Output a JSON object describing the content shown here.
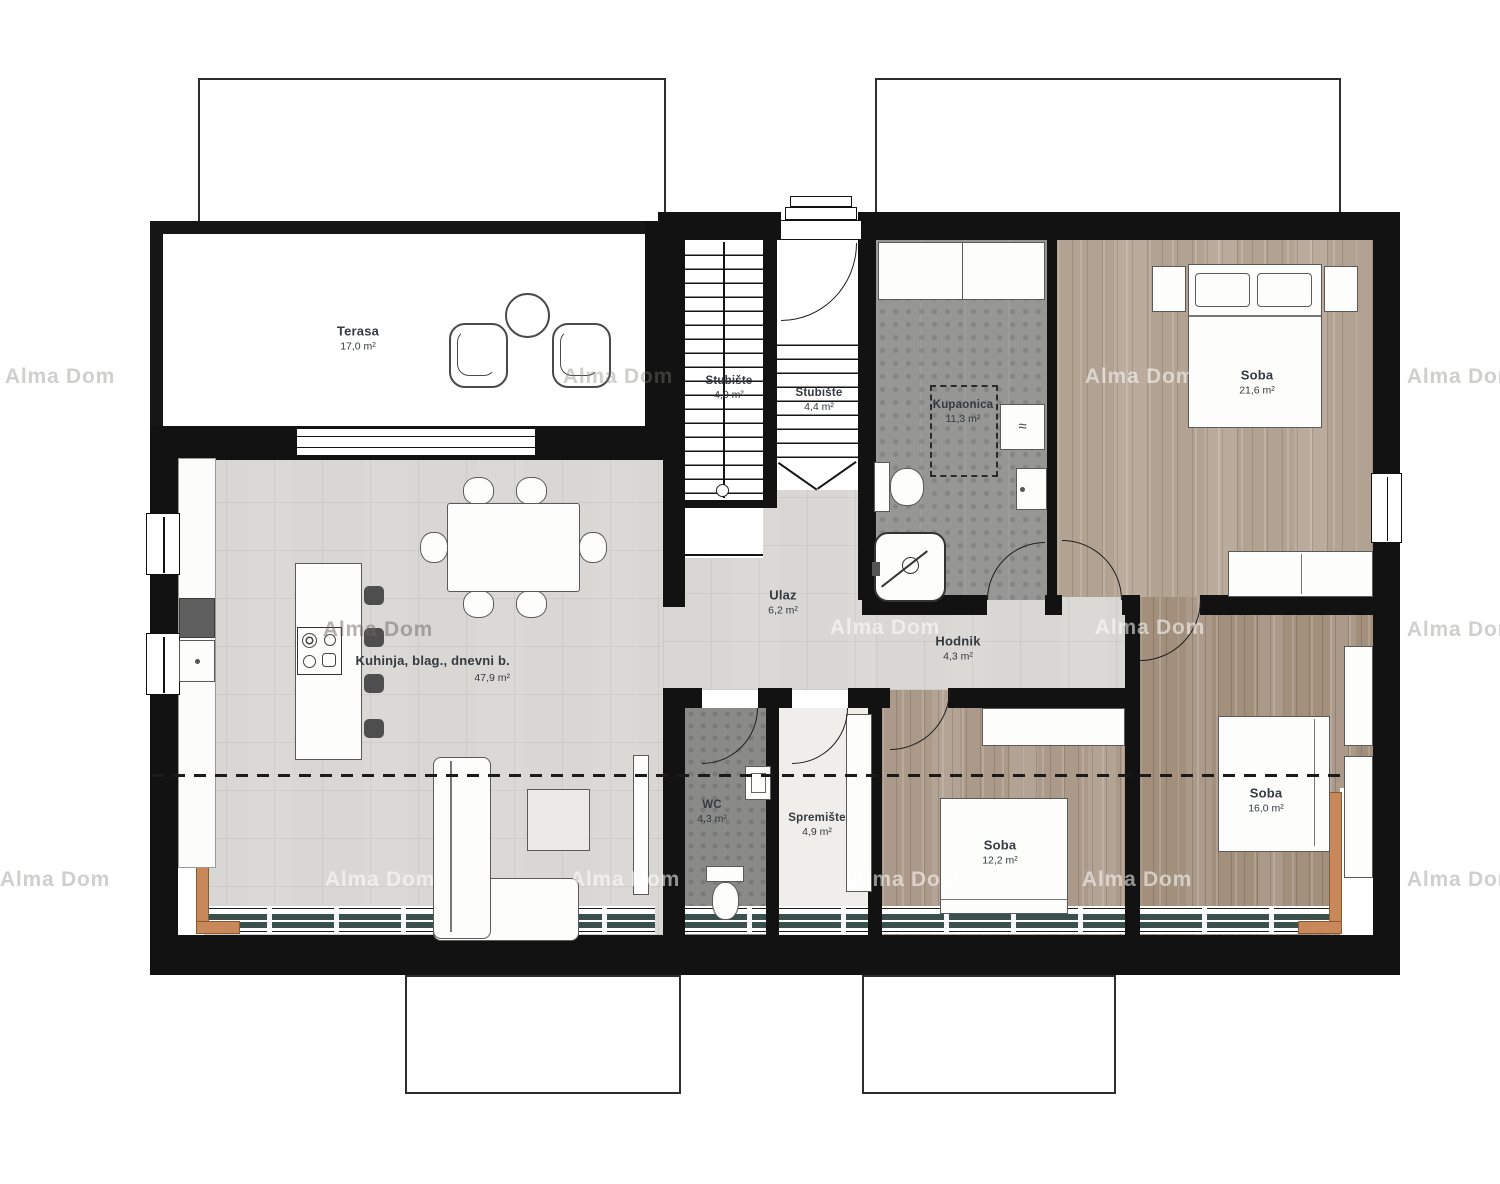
{
  "plan": {
    "watermark": "Alma Dom",
    "rooms": {
      "terasa": {
        "name": "Terasa",
        "area": "17,0 m²"
      },
      "stubiste1": {
        "name": "Stubište",
        "area": "4,0 m²"
      },
      "stubiste2": {
        "name": "Stubište",
        "area": "4,4 m²"
      },
      "kupaonica": {
        "name": "Kupaonica",
        "area": "11,3 m²"
      },
      "soba1": {
        "name": "Soba",
        "area": "21,6 m²"
      },
      "kuhinja": {
        "name": "Kuhinja, blag., dnevni b.",
        "area": "47,9 m²"
      },
      "ulaz": {
        "name": "Ulaz",
        "area": "6,2 m²"
      },
      "hodnik": {
        "name": "Hodnik",
        "area": "4,3 m²"
      },
      "wc": {
        "name": "WC",
        "area": "4,3 m²"
      },
      "spremiste": {
        "name": "Spremište",
        "area": "4,9 m²"
      },
      "soba2": {
        "name": "Soba",
        "area": "12,2 m²"
      },
      "soba3": {
        "name": "Soba",
        "area": "16,0 m²"
      }
    },
    "fixtures": {
      "washer_symbol": "≈"
    },
    "colors": {
      "wall": "#121212",
      "floorLight": "#d8d7d3",
      "floorDark": "#969695",
      "floorDarker": "#8a8a89",
      "floorPale": "#efeeea",
      "wood": "#b2a292",
      "woodMid": "#ab9a89",
      "woodDark": "#a28f7c",
      "rail": "#c8885a",
      "glass": "#3a514b",
      "ink": "#343a40",
      "line": "#5a5a5a"
    }
  }
}
